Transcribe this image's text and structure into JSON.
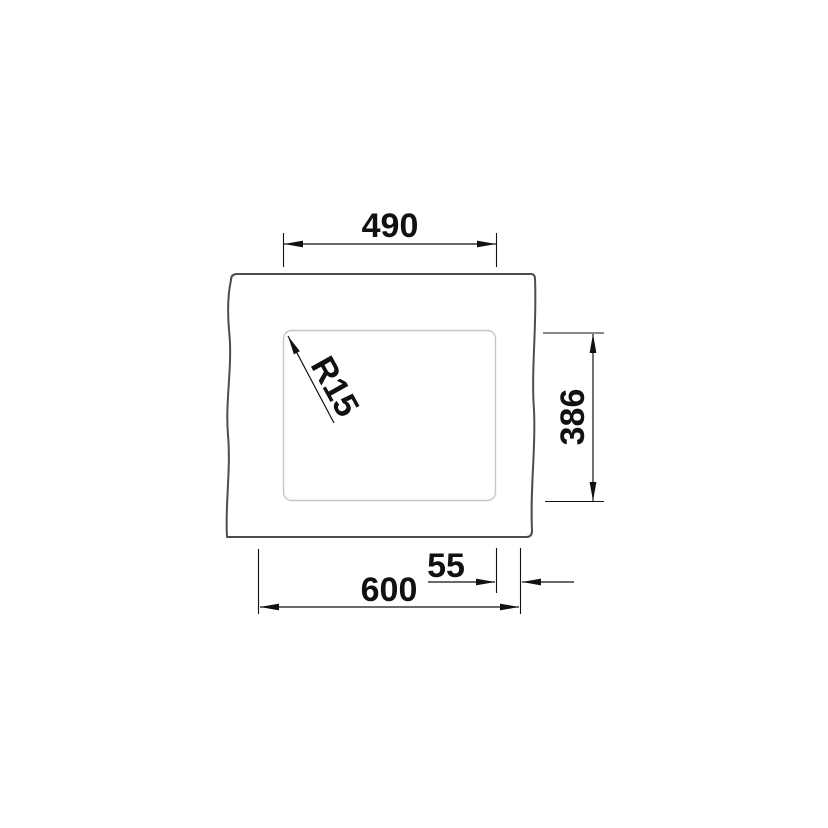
{
  "drawing": {
    "type": "technical-dimension-drawing",
    "subject": "undermount-sink-top-view",
    "dimensions": {
      "inner_width": "490",
      "inner_height": "386",
      "overall_width": "600",
      "right_offset": "55",
      "corner_radius": "R15"
    },
    "colors": {
      "background": "#ffffff",
      "outline": "#4d4d4d",
      "inner_line": "#c6c6c6",
      "dimension": "#111111"
    }
  }
}
